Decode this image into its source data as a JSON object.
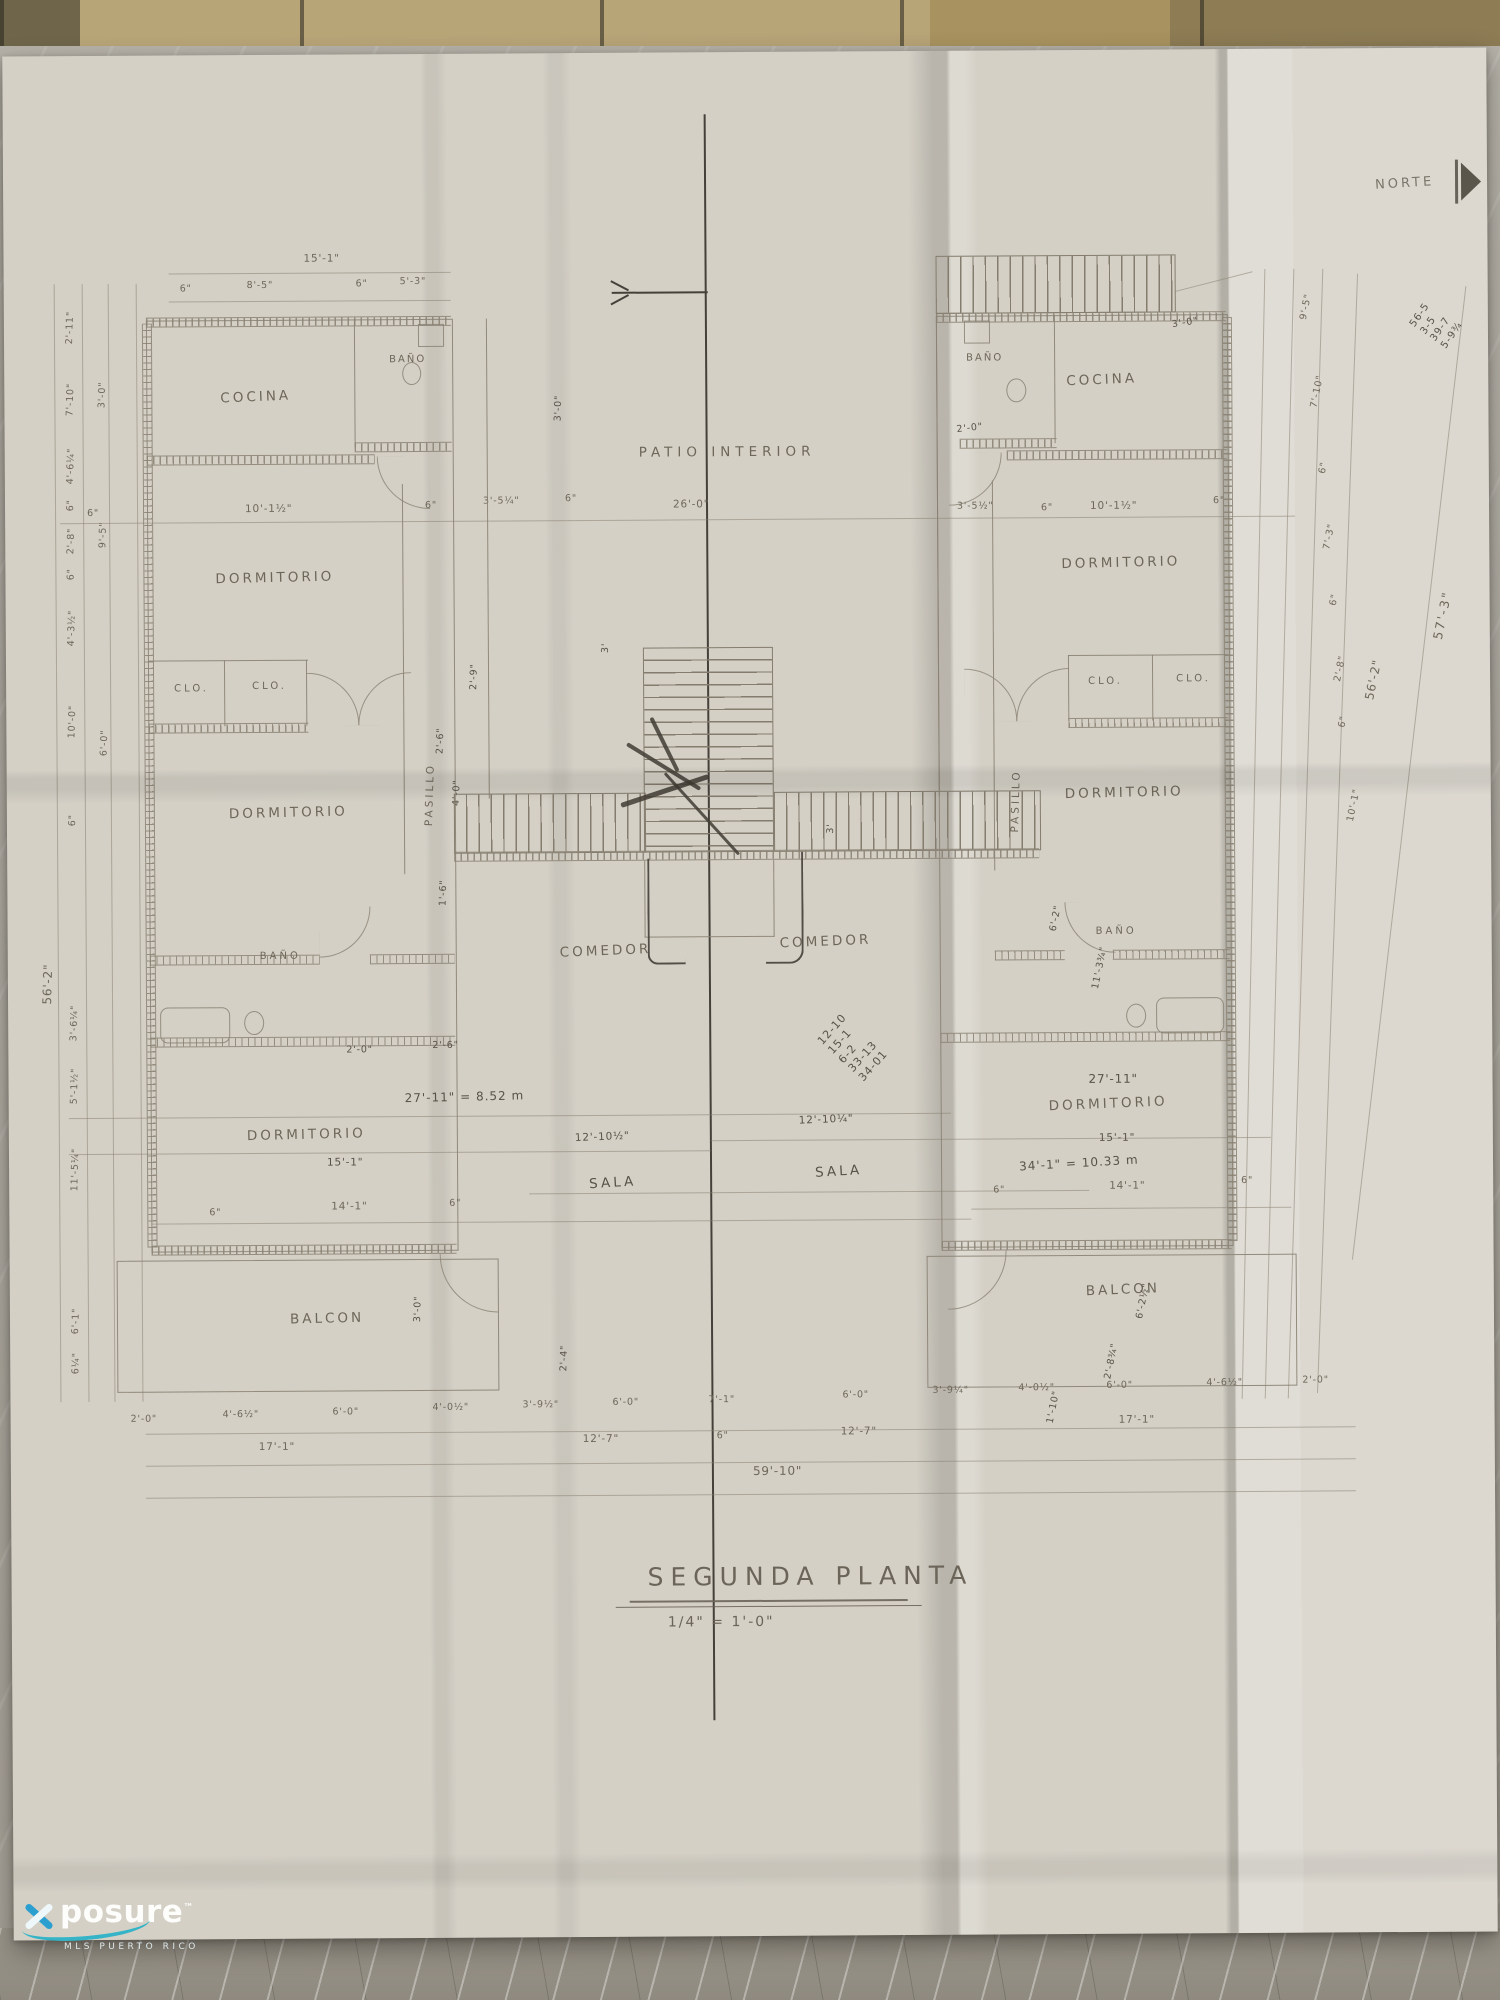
{
  "photo": {
    "surface": "marble countertop with tile backsplash",
    "tile_strip_color": "#b7a477",
    "marble_color": "#b0aca3",
    "paper_color": "#d4d0c6",
    "ink_color": "#8a8273",
    "pencil_color": "#45403a"
  },
  "north": {
    "label": "NORTE"
  },
  "title": {
    "text": "SEGUNDA PLANTA",
    "scale": "1/4\" = 1'-0\""
  },
  "watermark": {
    "brand": "posure",
    "tm": "™",
    "tagline": "MLS PUERTO RICO"
  },
  "center": {
    "patio_label": "PATIO INTERIOR",
    "patio_width_dim": "26'-0\"",
    "stair_width_dim_top": "3'",
    "stair_width_dim_right": "3'",
    "stair_offset_dim": "3'-0\"",
    "comedor_left": "COMEDOR",
    "comedor_right": "COMEDOR",
    "sala_left": "SALA",
    "sala_right": "SALA",
    "sala_dim_left": "12'-10½\"",
    "sala_dim_right": "12'-10¼\"",
    "sum_note": "12-10\n15-1\n6-2\n33-13\n34-01"
  },
  "left_unit": {
    "cocina": "COCINA",
    "bano_top": "BAÑO",
    "dormitorio_1": "DORMITORIO",
    "closet_1": "CLO.",
    "closet_2": "CLO.",
    "dormitorio_2": "DORMITORIO",
    "pasillo": "PASILLO",
    "bano_2": "BAÑO",
    "dormitorio_3": "DORMITORIO",
    "balcon": "BALCON",
    "top_dim_total": "15'-1\"",
    "top_dim_segments": [
      "6\"",
      "8'-5\"",
      "6\"",
      "5'-3\""
    ],
    "mid_dim_segments": [
      "6\"",
      "10'-1½\"",
      "6\"",
      "3'-5¼\"",
      "6\""
    ],
    "pasillo_dims": [
      "2'-9\"",
      "2'-6\"",
      "4'-0\"",
      "1'-6\""
    ],
    "door_dims": [
      "2'-0\"",
      "2'-6\""
    ],
    "width_dim_note": "27'-11\" = 8.52 m",
    "dorm3_length_dim": "15'-1\"",
    "dorm3_inner_dim": "14'-1\"",
    "dorm3_side_dim_left": "6\"",
    "dorm3_side_dim_right": "6\"",
    "balcon_depth_dim": "3'-0\"",
    "balcon_side_dim": "2'-4\""
  },
  "right_unit": {
    "bano_top": "BAÑO",
    "cocina": "COCINA",
    "entry_dim": "3'-0\"",
    "door_dim": "2'-0\"",
    "mid_dim_segments": [
      "3'-5½\"",
      "6\"",
      "10'-1½\"",
      "6\""
    ],
    "dormitorio_1": "DORMITORIO",
    "closet_1": "CLO.",
    "closet_2": "CLO.",
    "dormitorio_2": "DORMITORIO",
    "pasillo": "PASILLO",
    "bano_2": "BAÑO",
    "width_dim": "27'-11\"",
    "dormitorio_3": "DORMITORIO",
    "dorm3_length_dim": "15'-1\"",
    "area_note": "34'-1\" = 10.33 m",
    "dorm3_inner_dim": "14'-1\"",
    "dorm3_side_dim_left": "6\"",
    "dorm3_side_dim_right": "6\"",
    "balcon": "BALCON"
  },
  "dims": {
    "bottom_row1": [
      "2'-0\"",
      "4'-6½\"",
      "6'-0\"",
      "4'-0½\"",
      "3'-9½\"",
      "6'-0\"",
      "7'-1\"",
      "6'-0\"",
      "3'-9¼\"",
      "4'-0½\"",
      "6'-0\"",
      "4'-6½\"",
      "2'-0\""
    ],
    "bottom_row2": [
      "17'-1\"",
      "12'-7\"",
      "6\"",
      "12'-7\"",
      "17'-1\""
    ],
    "bottom_total": "59'-10\"",
    "left_chain": [
      "2'-11\"",
      "7'-10\"",
      "3'-0\"",
      "4'-6¼\"",
      "6\"",
      "2'-8\"",
      "6\"",
      "9'-5\"",
      "4'-3½\"",
      "10'-0\"",
      "6'-0\"",
      "56'-2\"",
      "6\"",
      "3'-6¼\"",
      "5'-1½\"",
      "11'-5¼\"",
      "6'-1\"",
      "6¼\""
    ],
    "right_chain": [
      "9'-5\"",
      "7'-10\"",
      "6\"",
      "7'-3\"",
      "6\"",
      "2'-8\"",
      "6\"",
      "10'-1\"",
      "56'-2\"",
      "57'-3\"",
      "6'-2\"",
      "11'-3¾\"",
      "2'-8¾\"",
      "1'-10\"",
      "6'-2½\"",
      "2'-0\""
    ],
    "sum_note_right": "56-5\n3-5\n39-7\n5-9¾"
  }
}
